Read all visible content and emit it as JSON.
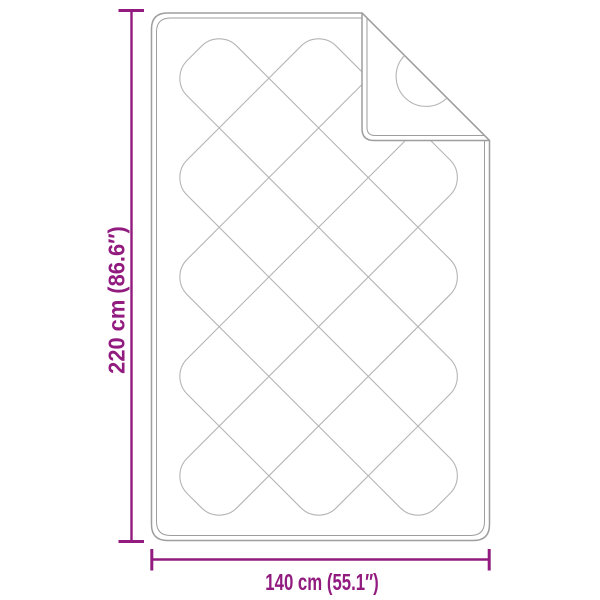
{
  "diagram": {
    "type": "product-dimension-diagram",
    "subject": "quilted blanket with folded top-right corner",
    "height_label": "220 cm (86.6″)",
    "width_label": "140 cm (55.1″)",
    "height_cm": 220,
    "height_inches": 86.6,
    "width_cm": 140,
    "width_inches": 55.1
  },
  "colors": {
    "dimension": "#921b7f",
    "blanket_outline": "#9e9e9e",
    "quilt_stitch": "#b5b5b5",
    "background": "#ffffff"
  }
}
